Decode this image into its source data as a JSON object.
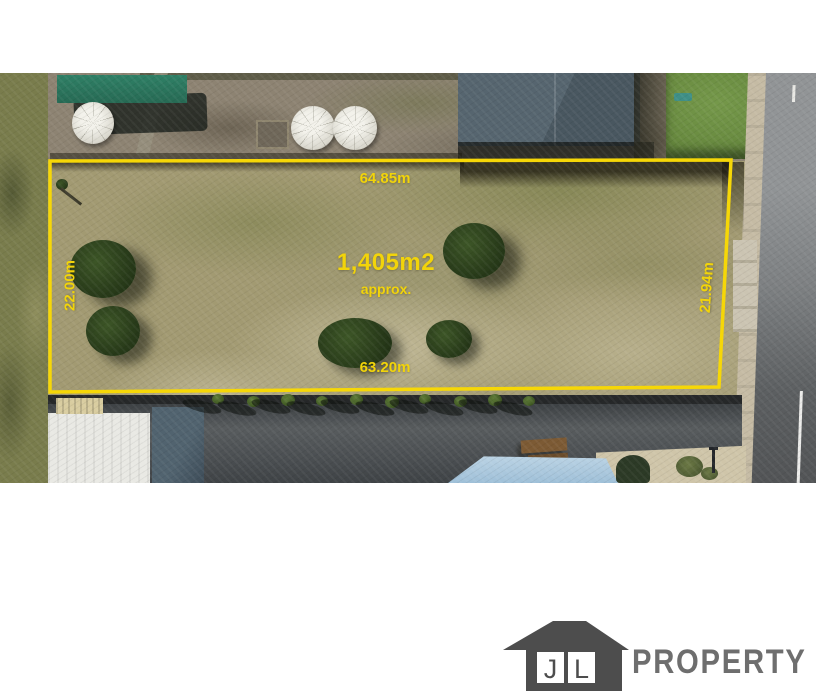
{
  "annotations": {
    "top_length": "64.85m",
    "bottom_length": "63.20m",
    "left_width": "22.00m",
    "right_width": "21.94m",
    "area": "1,405m2",
    "area_qualifier": "approx.",
    "text_color": "#F2D40A",
    "boundary_color": "#F6D707"
  },
  "logo": {
    "initial_first": "J",
    "initial_second": "L",
    "wordmark": "PROPERTY",
    "house_color": "#4D4D4D",
    "initial_color": "#4D4D4D",
    "wordmark_color": "#6E6E6E"
  }
}
